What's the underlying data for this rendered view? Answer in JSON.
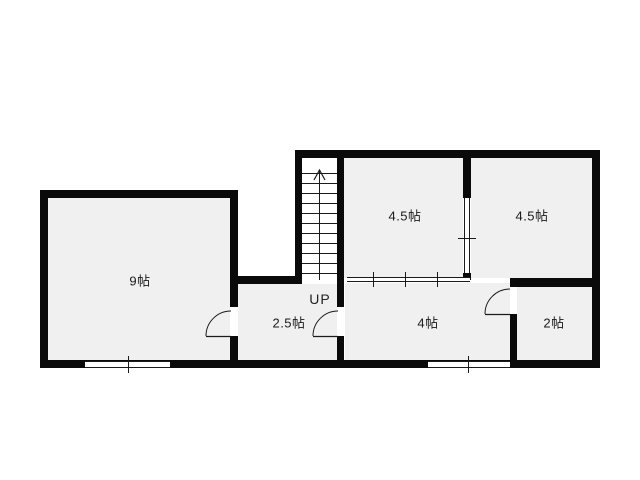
{
  "document": {
    "type": "floor-plan",
    "unit": "帖"
  },
  "floorplan": {
    "colors": {
      "background": "#ffffff",
      "wall": "#0a0a0a",
      "room_fill": "#f0f0f0",
      "stair_fill": "#ffffff",
      "line": "#1a1a1a",
      "label_text": "#1a1a1a"
    },
    "rooms": [
      {
        "name": "room-9jo",
        "label": "9帖",
        "size_jo": 9,
        "cx": 140,
        "cy": 280,
        "x": 48,
        "y": 198,
        "w": 182,
        "h": 162
      },
      {
        "name": "room-2_5jo",
        "label": "2.5帖",
        "size_jo": 2.5,
        "cx": 289,
        "cy": 322,
        "x": 238,
        "y": 284,
        "w": 99,
        "h": 76
      },
      {
        "name": "room-4jo",
        "label": "4帖",
        "size_jo": 4,
        "cx": 428,
        "cy": 322,
        "x": 345,
        "y": 283,
        "w": 165,
        "h": 77
      },
      {
        "name": "room-2jo",
        "label": "2帖",
        "size_jo": 2,
        "cx": 554,
        "cy": 322,
        "x": 517,
        "y": 287,
        "w": 75,
        "h": 73
      },
      {
        "name": "room-4_5jo-left",
        "label": "4.5帖",
        "size_jo": 4.5,
        "cx": 405,
        "cy": 215,
        "x": 344,
        "y": 158,
        "w": 119,
        "h": 120
      },
      {
        "name": "room-4_5jo-right",
        "label": "4.5帖",
        "size_jo": 4.5,
        "cx": 532,
        "cy": 215,
        "x": 471,
        "y": 158,
        "w": 121,
        "h": 120
      }
    ],
    "stairs": {
      "label": "UP",
      "cx": 320,
      "cy": 299,
      "x": 302,
      "y": 158,
      "w": 35,
      "h": 122,
      "tread_start_y": 173,
      "tread_step": 10,
      "tread_count": 11,
      "arrow": {
        "cx": 319.5,
        "apex_y": 170,
        "wing_y": 180,
        "wing_dx": 5.5,
        "line_bottom_y": 280
      },
      "direction": "up"
    },
    "walls": [
      {
        "name": "outer-top-wall",
        "x": 295,
        "y": 150,
        "w": 305,
        "h": 8
      },
      {
        "name": "outer-right-wall",
        "x": 592,
        "y": 150,
        "w": 8,
        "h": 218
      },
      {
        "name": "outer-bottom-wall",
        "x": 40,
        "y": 360,
        "w": 560,
        "h": 8
      },
      {
        "name": "room9-left-wall",
        "x": 40,
        "y": 190,
        "w": 8,
        "h": 178
      },
      {
        "name": "room9-top-wall",
        "x": 40,
        "y": 190,
        "w": 198,
        "h": 8
      },
      {
        "name": "room9-right-wall-upper",
        "x": 230,
        "y": 198,
        "w": 8,
        "h": 109
      },
      {
        "name": "room9-right-wall-lower",
        "x": 230,
        "y": 336,
        "w": 8,
        "h": 24
      },
      {
        "name": "notch-wall",
        "x": 230,
        "y": 276,
        "w": 72,
        "h": 8
      },
      {
        "name": "stairs-left-wall",
        "x": 295,
        "y": 150,
        "w": 7,
        "h": 130
      },
      {
        "name": "stairs-right-wall-upper",
        "x": 337,
        "y": 150,
        "w": 7,
        "h": 157
      },
      {
        "name": "stairs-right-wall-lower",
        "x": 337,
        "y": 336,
        "w": 7,
        "h": 24
      },
      {
        "name": "partition-wall-upper",
        "x": 463,
        "y": 158,
        "w": 8,
        "h": 40
      },
      {
        "name": "partition-wall-cap",
        "x": 463,
        "y": 273,
        "w": 8,
        "h": 7
      },
      {
        "name": "room2-top-wall",
        "x": 510,
        "y": 278,
        "w": 82,
        "h": 9
      },
      {
        "name": "room2-left-wall-lower",
        "x": 510,
        "y": 314,
        "w": 7,
        "h": 46
      }
    ],
    "windows": [
      {
        "name": "sliding-partition-4_5jo-bottom",
        "orientation": "h",
        "x": 347,
        "y": 277,
        "len": 123,
        "th": 5,
        "ticks": [
          373,
          405,
          437
        ]
      },
      {
        "name": "sliding-partition-4_5jo-middle",
        "orientation": "v",
        "x": 464,
        "y": 198,
        "len": 75,
        "th": 6,
        "ticks": [
          238
        ]
      },
      {
        "name": "window-9jo-bottom",
        "orientation": "h",
        "x": 85,
        "y": 361,
        "len": 85,
        "th": 7,
        "ticks": [
          128
        ]
      },
      {
        "name": "window-4jo-bottom",
        "orientation": "h",
        "x": 428,
        "y": 361,
        "len": 82,
        "th": 7,
        "ticks": [
          468
        ]
      }
    ],
    "doors": [
      {
        "name": "door-9jo",
        "hinge_x": 231,
        "hinge_y": 336,
        "radius": 25
      },
      {
        "name": "door-2_5jo",
        "hinge_x": 338,
        "hinge_y": 336,
        "radius": 25
      },
      {
        "name": "door-2jo",
        "hinge_x": 510,
        "hinge_y": 314,
        "radius": 25
      }
    ]
  }
}
